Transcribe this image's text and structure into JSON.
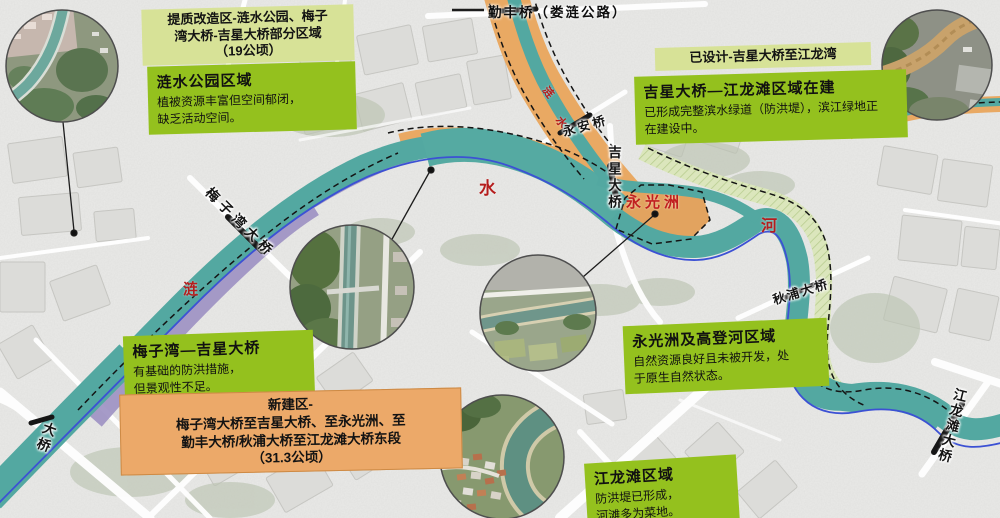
{
  "top_bridge": {
    "label": "勤丰桥（娄涟公路）"
  },
  "callouts": {
    "upgrade_tag": "提质改造区-涟水公园、梅子\n湾大桥-吉星大桥部分区域\n（19公顷）",
    "lianshui_park": {
      "title": "涟水公园区域",
      "body": "植被资源丰富但空间郁闭，\n缺乏活动空间。"
    },
    "designed_tag": "已设计-吉星大桥至江龙湾",
    "jixing_jianglongtan": {
      "title": "吉星大桥—江龙滩区域在建",
      "body": "已形成完整滨水绿道（防洪堤），滨江绿地正\n在建设中。"
    },
    "yongguang_gaodeng": {
      "title": "永光洲及高登河区域",
      "body": "自然资源良好且未被开发，处\n于原生自然状态。"
    },
    "meiziwan_jixing": {
      "title": "梅子湾—吉星大桥",
      "body": "有基础的防洪措施，\n但景观性不足。"
    },
    "new_area": "新建区-\n梅子湾大桥至吉星大桥、至永光洲、至\n勤丰大桥/秋浦大桥至江龙滩大桥东段\n（31.3公顷）",
    "jianglongtan": {
      "title": "江龙滩区域",
      "body": "防洪堤已形成，\n河滩多为菜地。"
    }
  },
  "map_labels": {
    "bridges": {
      "meiziwan": "梅子湾大桥",
      "yongan": "永安桥",
      "jixing": "吉星大桥",
      "qiupu": "秋浦大桥",
      "jianglongtan": "江龙滩大桥",
      "partial": "大桥"
    },
    "river": {
      "lian": "涟",
      "shui": "水",
      "he": "河",
      "up_lian": "涟",
      "up_shui": "水"
    },
    "islet": "永光洲"
  },
  "legend_colors": {
    "upgrade_purple": "#9e92c3",
    "new_orange": "#e9a963",
    "designed_green_band": "#dbe6bc",
    "river_teal": "#53a8a1",
    "callout_green": "#94c11e",
    "tag_green": "#d7e297",
    "orange_box": "#eca969",
    "red_label": "#b51d1d",
    "blue_edge_line": "#3c51d4"
  }
}
